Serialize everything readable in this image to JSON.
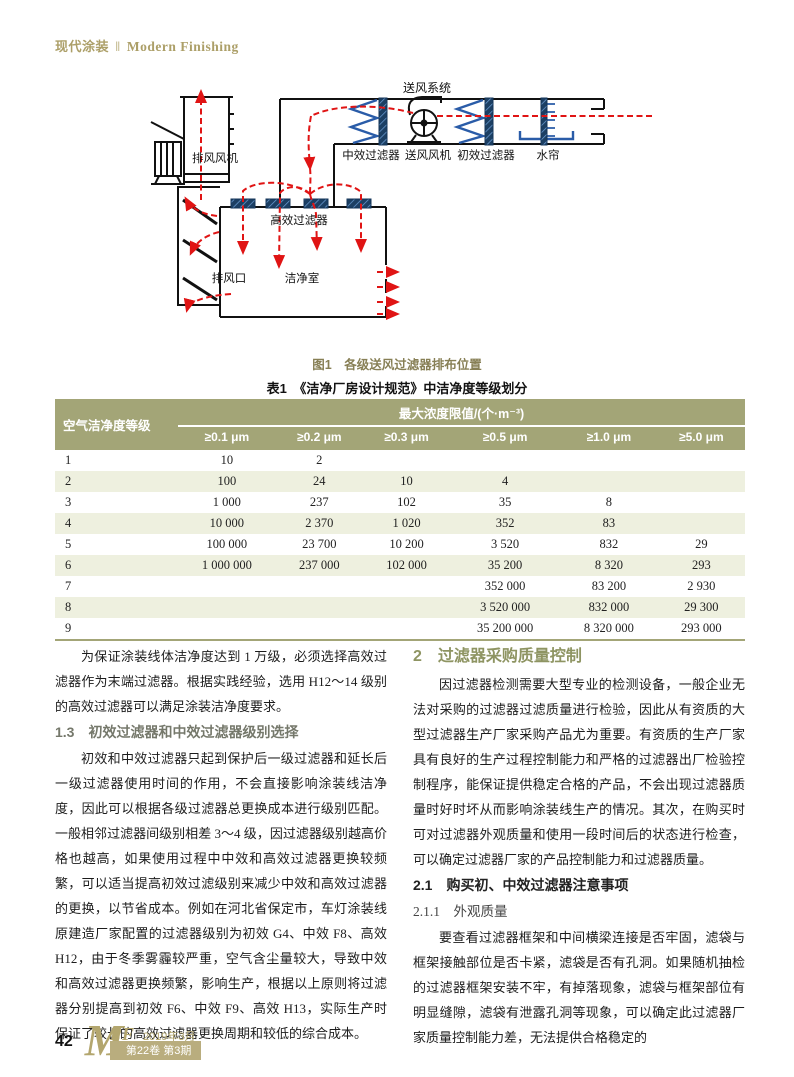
{
  "header": {
    "journal_cn": "现代涂装",
    "separator": "‖",
    "journal_en": "Modern Finishing"
  },
  "figure": {
    "caption": "图1　各级送风过滤器排布位置",
    "labels": {
      "supply_system": "送风系统",
      "exhaust_fan": "排风风机",
      "medium_filter": "中效过滤器",
      "supply_fan": "送风风机",
      "primary_filter": "初效过滤器",
      "water_curtain": "水帘",
      "hepa_filter": "高效过滤器",
      "exhaust_outlet": "排风口",
      "clean_room": "洁净室"
    }
  },
  "table": {
    "title": "表1　《洁净厂房设计规范》中洁净度等级划分",
    "row_header": "空气洁净度等级",
    "span_header": "最大浓度限值/(个·m⁻³)",
    "columns": [
      "≥0.1 μm",
      "≥0.2 μm",
      "≥0.3 μm",
      "≥0.5 μm",
      "≥1.0 μm",
      "≥5.0 μm"
    ],
    "rows": [
      {
        "grade": "1",
        "values": [
          "10",
          "2",
          "",
          "",
          "",
          ""
        ]
      },
      {
        "grade": "2",
        "values": [
          "100",
          "24",
          "10",
          "4",
          "",
          ""
        ]
      },
      {
        "grade": "3",
        "values": [
          "1 000",
          "237",
          "102",
          "35",
          "8",
          ""
        ]
      },
      {
        "grade": "4",
        "values": [
          "10 000",
          "2 370",
          "1 020",
          "352",
          "83",
          ""
        ]
      },
      {
        "grade": "5",
        "values": [
          "100 000",
          "23 700",
          "10 200",
          "3 520",
          "832",
          "29"
        ]
      },
      {
        "grade": "6",
        "values": [
          "1 000 000",
          "237 000",
          "102 000",
          "35 200",
          "8 320",
          "293"
        ]
      },
      {
        "grade": "7",
        "values": [
          "",
          "",
          "",
          "352 000",
          "83 200",
          "2 930"
        ]
      },
      {
        "grade": "8",
        "values": [
          "",
          "",
          "",
          "3 520 000",
          "832 000",
          "29 300"
        ]
      },
      {
        "grade": "9",
        "values": [
          "",
          "",
          "",
          "35 200 000",
          "8 320 000",
          "293 000"
        ]
      }
    ]
  },
  "article": {
    "left": [
      {
        "type": "p",
        "text": "为保证涂装线体洁净度达到 1 万级，必须选择高效过滤器作为末端过滤器。根据实践经验，选用 H12～14 级别的高效过滤器可以满足涂装洁净度要求。"
      },
      {
        "type": "h-gray",
        "text": "1.3　初效过滤器和中效过滤器级别选择"
      },
      {
        "type": "p",
        "text": "初效和中效过滤器只起到保护后一级过滤器和延长后一级过滤器使用时间的作用，不会直接影响涂装线洁净度，因此可以根据各级过滤器总更换成本进行级别匹配。一般相邻过滤器间级别相差 3～4 级，因过滤器级别越高价格也越高，如果使用过程中中效和高效过滤器更换较频繁，可以适当提高初效过滤级别来减少中效和高效过滤器的更换，以节省成本。例如在河北省保定市，车灯涂装线原建造厂家配置的过滤器级别为初效 G4、中效 F8、高效 H12，由于冬季雾霾较严重，空气含尘量较大，导致中效和高效过滤器更换频繁，影响生产，根据以上原则将过滤器分别提高到初效 F6、中效 F9、高效 H13，实际生产时保证了较长的高效过滤器更换周期和较低的综合成本。"
      }
    ],
    "right": [
      {
        "type": "h-green",
        "text": "2　过滤器采购质量控制"
      },
      {
        "type": "p",
        "text": "因过滤器检测需要大型专业的检测设备，一般企业无法对采购的过滤器过滤质量进行检验，因此从有资质的大型过滤器生产厂家采购产品尤为重要。有资质的生产厂家具有良好的生产过程控制能力和严格的过滤器出厂检验控制程序，能保证提供稳定合格的产品，不会出现过滤器质量时好时坏从而影响涂装线生产的情况。其次，在购买时可对过滤器外观质量和使用一段时间后的状态进行检查，可以确定过滤器厂家的产品控制能力和过滤器质量。"
      },
      {
        "type": "h-black",
        "text": "2.1　购买初、中效过滤器注意事项"
      },
      {
        "type": "h-kai",
        "text": "2.1.1　外观质量"
      },
      {
        "type": "p",
        "text": "要查看过滤器框架和中间横梁连接是否牢固，滤袋与框架接触部位是否卡紧，滤袋是否有孔洞。如果随机抽检的过滤器框架安装不牢，有掉落现象，滤袋与框架部位有明显缝隙，滤袋有泄露孔洞等现象，可以确定此过滤器厂家质量控制能力差，无法提供合格稳定的"
      }
    ]
  },
  "footer": {
    "page_number": "42",
    "logo_m": "M",
    "logo_pf": "PF",
    "issue_date": "2019年3月",
    "volume_issue": "第22卷 第3期"
  },
  "colors": {
    "brand_khaki": "#b0a26c",
    "table_header_bg": "#a3a577",
    "row_alt_bg": "#eef0df",
    "heading_green": "#8e9462",
    "heading_gray": "#75786b",
    "flow_red": "#e01414",
    "diagram_blue": "#2a5ca8",
    "filter_navy": "#1c3f63"
  }
}
